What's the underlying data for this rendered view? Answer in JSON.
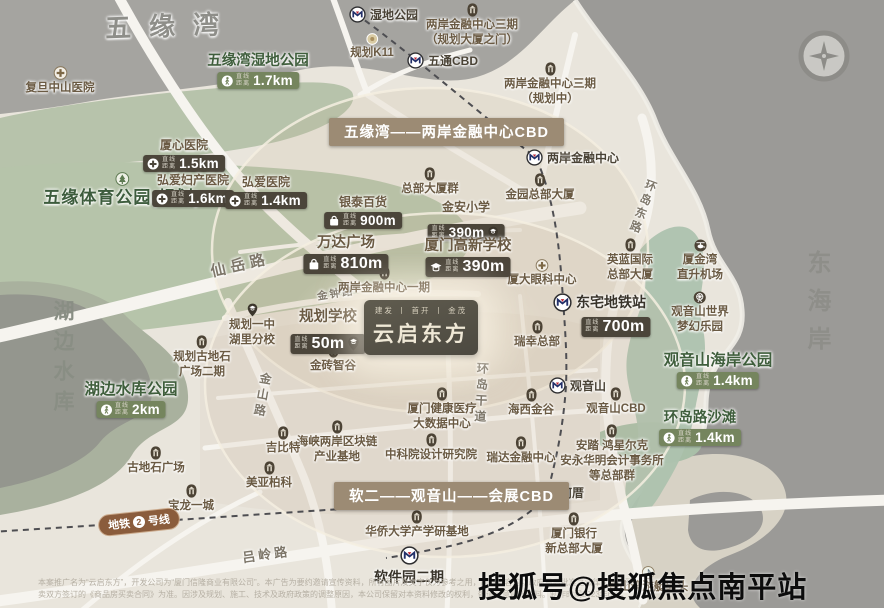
{
  "areas": {
    "bay": "五缘湾",
    "coast": "东海岸",
    "lake": "湖边水库",
    "sports_park": "五缘体育公园(规划)"
  },
  "banners": {
    "top": "五缘湾——两岸金融中心CBD",
    "bottom": "软二——观音山——会展CBD"
  },
  "project": {
    "brands": "建发 丨 首开 丨 金茂",
    "name": "云启东方"
  },
  "metro_stations": [
    "湿地公园",
    "五通CBD",
    "两岸金融中心",
    "东宅地铁站",
    "观音山",
    "何厝",
    "软件园二期"
  ],
  "line2": {
    "pre": "地铁",
    "num": "2",
    "post": "号线"
  },
  "badge_prefix_1": "直线",
  "badge_prefix_2": "距离",
  "badged": [
    {
      "label": "厦心医院",
      "distance": "1.5km"
    },
    {
      "label": "弘爱妇产医院",
      "distance": "1.6km"
    },
    {
      "label": "弘爱医院",
      "distance": "1.4km"
    },
    {
      "label": "银泰百货",
      "distance": "900m"
    },
    {
      "label": "金安小学",
      "distance": "390m"
    },
    {
      "label": "万达广场",
      "distance": "810m"
    },
    {
      "label": "厦门高新学校",
      "distance": "390m"
    },
    {
      "label": "规划学校",
      "distance": "50m"
    },
    {
      "label": "东宅地铁站",
      "distance": "700m"
    }
  ],
  "parks": [
    {
      "label": "五缘湾湿地公园",
      "distance": "1.7km"
    },
    {
      "label": "湖边水库公园",
      "distance": "2km"
    },
    {
      "label": "观音山海岸公园",
      "distance": "1.4km"
    },
    {
      "label": "环岛路沙滩",
      "distance": "1.4km"
    }
  ],
  "pois": [
    {
      "label": "复旦中山医院"
    },
    {
      "label": "规划K11"
    },
    {
      "label": "两岸金融中心三期",
      "sub": "（规划大厦之门）"
    },
    {
      "label": "两岸金融中心三期",
      "sub": "（规划中）"
    },
    {
      "label": "总部大厦群"
    },
    {
      "label": "金园总部大厦"
    },
    {
      "label": "两岸金融中心一期"
    },
    {
      "label": "厦大眼科中心"
    },
    {
      "label": "英蓝国际",
      "sub": "总部大厦"
    },
    {
      "label": "厦金湾",
      "sub": "直升机场"
    },
    {
      "label": "观音山世界",
      "sub": "梦幻乐园"
    },
    {
      "label": "金砖智谷"
    },
    {
      "label": "瑞幸总部"
    },
    {
      "label": "规划一中",
      "sub": "湖里分校"
    },
    {
      "label": "规划古地石",
      "sub": "广场二期"
    },
    {
      "label": "观音山CBD"
    },
    {
      "label": "海西金谷"
    },
    {
      "label": "瑞达金融中心"
    },
    {
      "label": "厦门健康医疗",
      "sub": "大数据中心"
    },
    {
      "label": "海峡两岸区块链",
      "sub": "产业基地"
    },
    {
      "label": "中科院设计研究院"
    },
    {
      "label": "安踏 鸿星尔克",
      "sub": "安永华明会计事务所",
      "sub2": "等总部群"
    },
    {
      "label": "古地石广场"
    },
    {
      "label": "宝龙一城"
    },
    {
      "label": "吉比特"
    },
    {
      "label": "美亚柏科"
    },
    {
      "label": "华侨大学产学研基地"
    },
    {
      "label": "厦门银行",
      "sub": "新总部大厦"
    },
    {
      "label": "香山湾游艇码头"
    }
  ],
  "roads": [
    "仙岳路",
    "金钟路",
    "金山路",
    "环岛东路",
    "环岛干道",
    "吕岭路"
  ],
  "watermark": "搜狐号@搜狐焦点南平站",
  "disclaimer": {
    "line1": "本案推广名为“云启东方”，开发公司为“厦门信隆商业有限公司”。本广告为要约邀请宣传资料，所有图片及文字仅为参考之用，所有内容均以政府最后批准之法律文件及买",
    "line2": "卖双方签订的《商品房买卖合同》为准。因涉及规划、施工、技术及政府政策的调整原因，本公司保留对本资料修改的权利，敬请留意最新资料。制作时间2023年6月。"
  }
}
